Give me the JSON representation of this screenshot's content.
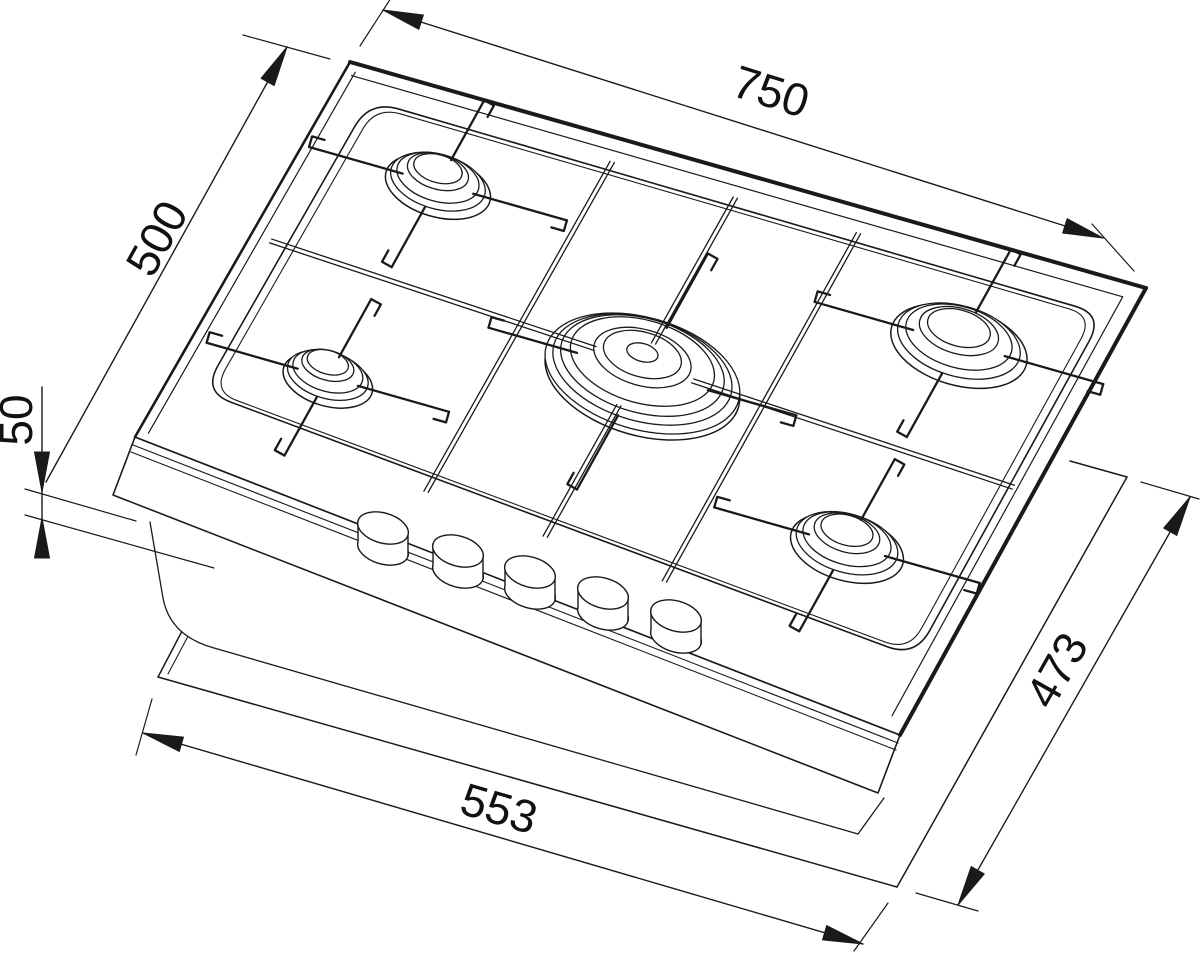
{
  "title": "Gas hob dimensional drawing",
  "diagram": {
    "type": "technical-drawing",
    "subject": "5-burner gas hob shown lifted above worktop cutout, perspective view",
    "units": "mm",
    "dimensions": [
      {
        "id": "width",
        "label": "750",
        "meaning": "hob overall width"
      },
      {
        "id": "depth",
        "label": "500",
        "meaning": "hob overall depth"
      },
      {
        "id": "height",
        "label": "50",
        "meaning": "hob body height"
      },
      {
        "id": "cutout_width",
        "label": "553",
        "meaning": "worktop cutout width"
      },
      {
        "id": "cutout_depth",
        "label": "473",
        "meaning": "worktop cutout depth"
      }
    ],
    "features": {
      "burners": 5,
      "control_knobs": 5,
      "pan_supports": true
    },
    "colors": {
      "line": "#1a1a1a",
      "background": "#ffffff"
    }
  }
}
